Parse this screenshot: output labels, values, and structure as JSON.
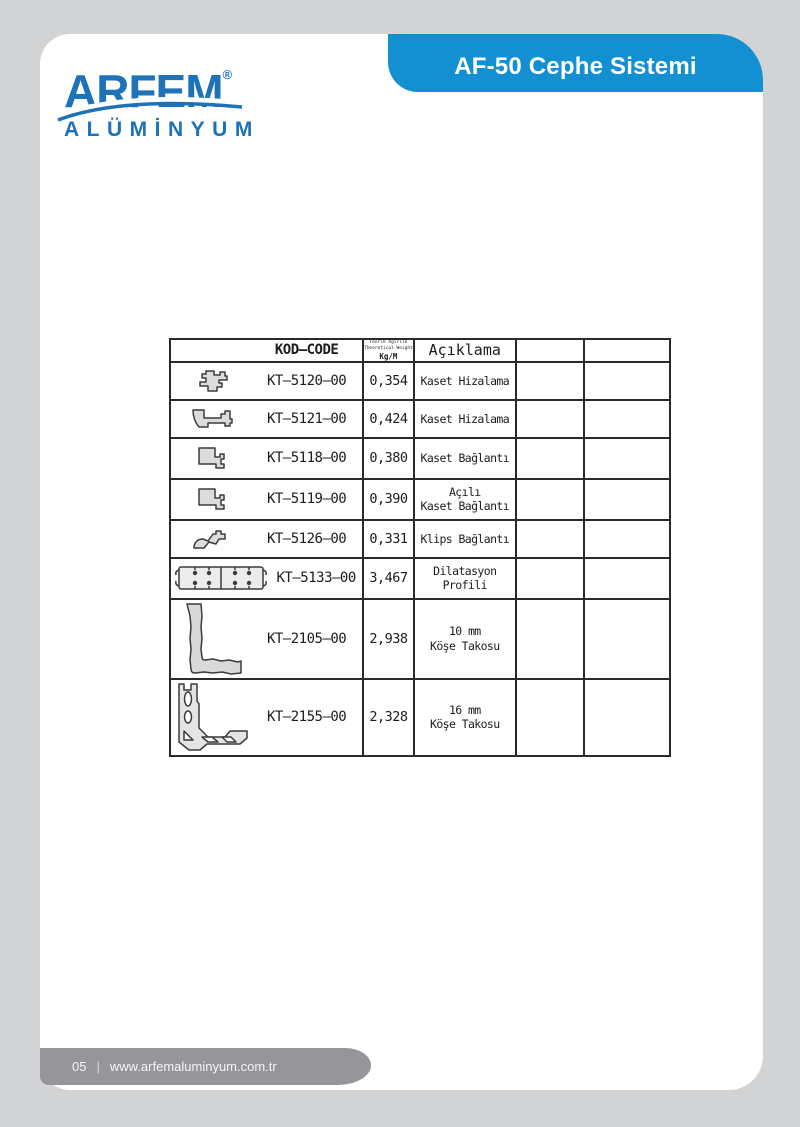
{
  "colors": {
    "page_background": "#d2d3d5",
    "brand_blue": "#1d72b8",
    "header_blue": "#1390d2",
    "footer_gray": "#95959a"
  },
  "brand": {
    "name": "ARFEM",
    "registered_mark": "®",
    "subtitle": "ALÜMİNYUM"
  },
  "header": {
    "title": "AF-50 Cephe Sistemi"
  },
  "table": {
    "headers": {
      "code": "KOD–CODE",
      "weight_line1": "Teorik Ağırlık",
      "weight_line2": "Theoretical Weight",
      "weight_unit": "Kg/M",
      "description": "Açıklama"
    },
    "rows": [
      {
        "profile": "clip-cross-profile",
        "code": "KT–5120–00",
        "weight": "0,354",
        "desc1": "Kaset Hizalama",
        "desc2": ""
      },
      {
        "profile": "channel-sled-profile",
        "code": "KT–5121–00",
        "weight": "0,424",
        "desc1": "Kaset Hizalama",
        "desc2": ""
      },
      {
        "profile": "bracket-profile",
        "code": "KT–5118–00",
        "weight": "0,380",
        "desc1": "Kaset Bağlantı",
        "desc2": ""
      },
      {
        "profile": "angled-bracket-profile",
        "code": "KT–5119–00",
        "weight": "0,390",
        "desc1": "Açılı",
        "desc2": "Kaset Bağlantı"
      },
      {
        "profile": "clips-profile",
        "code": "KT–5126–00",
        "weight": "0,331",
        "desc1": "Klips Bağlantı",
        "desc2": ""
      },
      {
        "profile": "dilatation-profile",
        "code": "KT–5133–00",
        "weight": "3,467",
        "desc1": "Dilatasyon",
        "desc2": "Profili"
      },
      {
        "profile": "corner-block-10mm-profile",
        "code": "KT–2105–00",
        "weight": "2,938",
        "desc1": "10 mm",
        "desc2": "Köşe Takosu"
      },
      {
        "profile": "corner-block-16mm-profile",
        "code": "KT–2155–00",
        "weight": "2,328",
        "desc1": "16 mm",
        "desc2": "Köşe Takosu"
      }
    ]
  },
  "footer": {
    "page_number": "05",
    "separator": "|",
    "url": "www.arfemaluminyum.com.tr"
  }
}
